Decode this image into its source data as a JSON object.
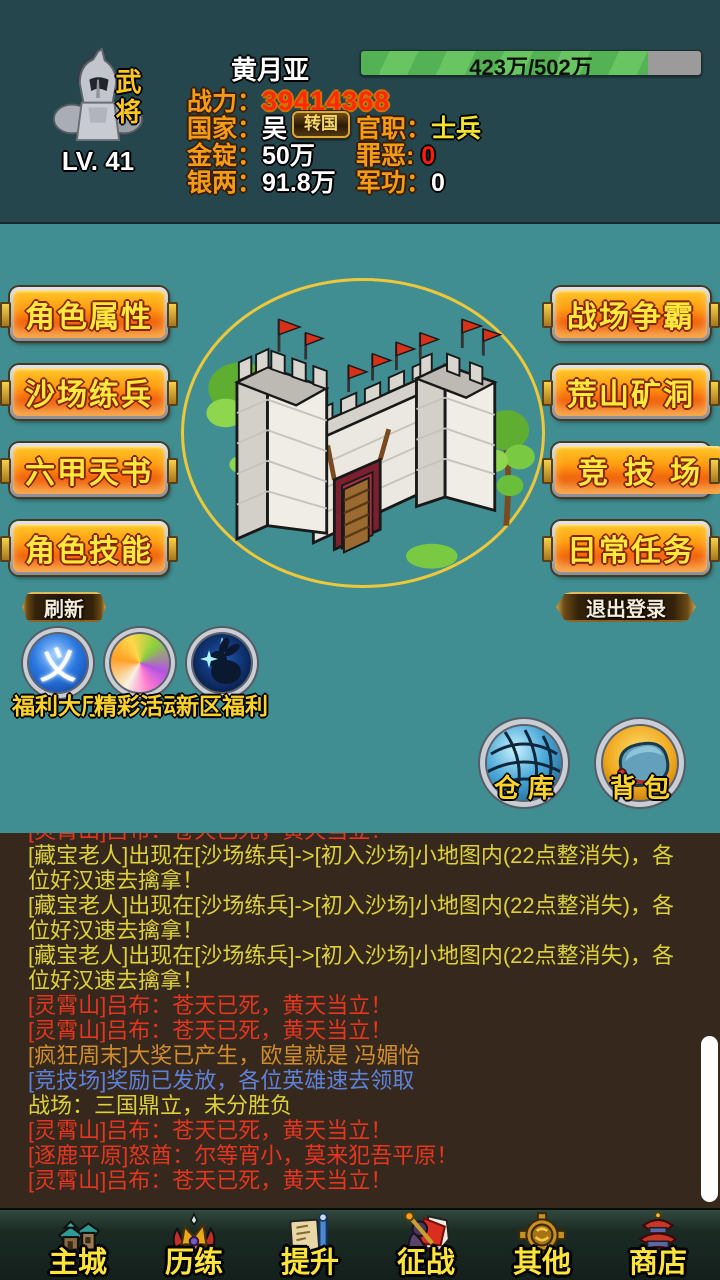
{
  "header": {
    "avatar_tag": "武将",
    "level": "LV. 41",
    "name": "黄月亚",
    "hp": {
      "text": "423万/502万",
      "fill_style": "width:84.3%"
    },
    "rows": {
      "power": {
        "label": "战力：",
        "value": "39414368"
      },
      "country": {
        "label": "国家：",
        "value": "吴"
      },
      "transfer_button": "转国",
      "rank": {
        "label": "官职：",
        "value": "士兵"
      },
      "gold": {
        "label": "金锭：",
        "value": "50万"
      },
      "sin": {
        "label": "罪恶:",
        "value": "0"
      },
      "silver": {
        "label": "银两：",
        "value": "91.8万"
      },
      "merit": {
        "label": "军功：",
        "value": "0"
      }
    }
  },
  "menu": {
    "left": [
      "角色属性",
      "沙场练兵",
      "六甲天书",
      "角色技能"
    ],
    "right": [
      "战场争霸",
      "荒山矿洞",
      "竞技场",
      "日常任务"
    ],
    "refresh": "刷新",
    "logout": "退出登录"
  },
  "shortcuts": [
    {
      "label": "福利大厅",
      "glyph": "义"
    },
    {
      "label": "精彩活动"
    },
    {
      "label": "新区福利"
    }
  ],
  "storage": {
    "warehouse": "仓库",
    "backpack": "背包"
  },
  "chat": {
    "messages": [
      {
        "text": "[灵霄山]吕布：苍天已死，黄天当立！",
        "color": "red"
      },
      {
        "text": "[藏宝老人]出现在[沙场练兵]->[初入沙场]小地图内(22点整消失)，各位好汉速去擒拿！",
        "color": "yellow"
      },
      {
        "text": "[藏宝老人]出现在[沙场练兵]->[初入沙场]小地图内(22点整消失)，各位好汉速去擒拿！",
        "color": "yellow"
      },
      {
        "text": "[藏宝老人]出现在[沙场练兵]->[初入沙场]小地图内(22点整消失)，各位好汉速去擒拿！",
        "color": "yellow"
      },
      {
        "text": "[灵霄山]吕布：苍天已死，黄天当立！",
        "color": "red"
      },
      {
        "text": "[灵霄山]吕布：苍天已死，黄天当立！",
        "color": "red"
      },
      {
        "text": "[疯狂周末]大奖已产生，欧皇就是 冯媚怡",
        "color": "orange"
      },
      {
        "text": "[竞技场]奖励已发放，各位英雄速去领取",
        "color": "blue"
      },
      {
        "text": "战场：三国鼎立，未分胜负",
        "color": "yellow"
      },
      {
        "text": "[灵霄山]吕布：苍天已死，黄天当立！",
        "color": "red"
      },
      {
        "text": "[逐鹿平原]怒酋：尔等宵小，莫来犯吾平原！",
        "color": "red"
      },
      {
        "text": "[灵霄山]吕布：苍天已死，黄天当立！",
        "color": "red"
      }
    ]
  },
  "nav": {
    "items": [
      {
        "label": "主城"
      },
      {
        "label": "历练"
      },
      {
        "label": "提升"
      },
      {
        "label": "征战"
      },
      {
        "label": "其他"
      },
      {
        "label": "商店"
      }
    ]
  },
  "colors": {
    "accent_gold": "#eec83a",
    "hp_green": "#58b356",
    "chat_red": "#e63620",
    "chat_yellow": "#ddd13a",
    "chat_orange": "#d18e2e",
    "chat_blue": "#5e82da"
  }
}
